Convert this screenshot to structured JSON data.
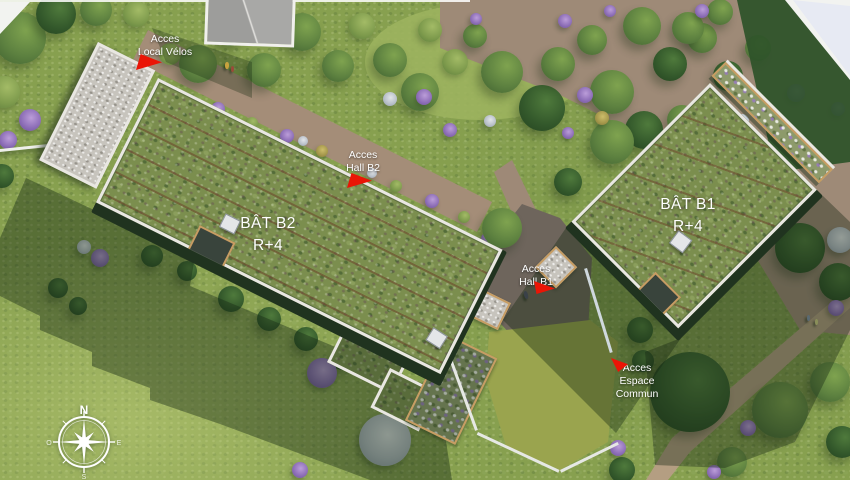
{
  "buildings": {
    "b2": {
      "name": "BÂT B2",
      "level": "R+4"
    },
    "b1": {
      "name": "BÂT B1",
      "level": "R+4"
    }
  },
  "markers": {
    "local_velos": {
      "l1": "Acces",
      "l2": "Local Vélos"
    },
    "hall_b2": {
      "l1": "Acces",
      "l2": "Hall B2"
    },
    "hall_b1": {
      "l1": "Acces",
      "l2": "Hall B1"
    },
    "espace_commun": {
      "l1": "Acces",
      "l2": "Espace",
      "l3": "Commun"
    }
  },
  "compass": {
    "n": "N",
    "s": "S",
    "e": "E",
    "w": "O"
  },
  "palette": {
    "arrow_red": "#ea1506",
    "label_text": "#ffffff",
    "roof_vegetation_green": "#7b8e4e",
    "grass_green": "#87a04f",
    "path_brown": "#a18b77",
    "gravel_grey": "#c7c4bd",
    "parapet_white": "#e9e7e2"
  }
}
